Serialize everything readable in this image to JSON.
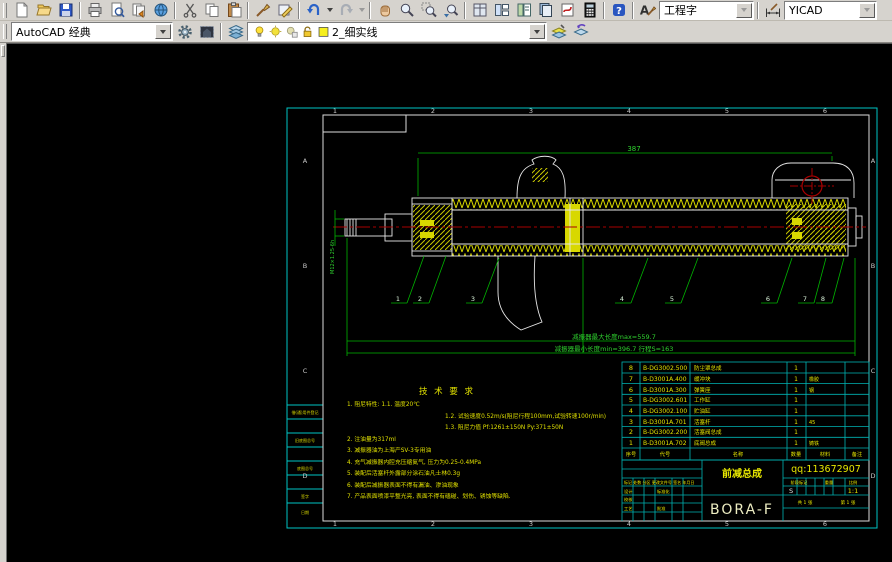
{
  "app": {
    "canvas_bg": "#000000",
    "toolbar_bg": "#d6d3ce",
    "frame_color": "#00c4c4",
    "dim_color": "#2fd32f",
    "hatch_color": "#d8d800"
  },
  "toolbar": {
    "workspace_combo": "AutoCAD 经典",
    "text_style_combo": "工程字",
    "dim_style_combo": "YICAD",
    "layer_combo": "2_细实线",
    "help_glyph": "?",
    "textstyle_glyph": "A"
  },
  "frame": {
    "zones": [
      "1",
      "2",
      "3",
      "4",
      "5",
      "6"
    ],
    "rows": [
      "A",
      "B",
      "C",
      "D"
    ],
    "margin_labels": [
      "借(通)用件登记",
      "旧底图总号",
      "底图总号",
      "签字",
      "日期"
    ]
  },
  "dims": {
    "overall": "387",
    "thread": "M12×1.25-6h",
    "max_len": "减振器最大长度max=559.7",
    "min_len": "减振器最小长度min=396.7  行程S=163"
  },
  "balloons": [
    "1",
    "2",
    "3",
    "4",
    "5",
    "6",
    "7",
    "8"
  ],
  "tech": {
    "title": "技 术 要 求",
    "lines": [
      "1. 阻尼特性: 1.1. 温度20℃",
      "1.2. 试验速度0.52m/s(阻尼行程100mm,试验转速100r/min)",
      "1.3. 阻尼力值  Pf:1261±150N   Py:371±50N",
      "2. 注油量为317ml",
      "3. 减振器油为上海产SV-3专用油",
      "4. 充气减振器内腔充压缩氮气, 压力为0.25-0.4MPa",
      "5. 装配后活塞杆外露部分涂石油凡士林0.3g",
      "6. 装配后减振器表面不得有漏油、渗油现象",
      "7. 产品表面喷漆平整光亮, 表面不得有磕碰、划伤、锈蚀等缺陷."
    ]
  },
  "bom": {
    "headers": [
      "序号",
      "代号",
      "名称",
      "数量",
      "材料",
      "备注"
    ],
    "rows": [
      {
        "no": "8",
        "code": "B-DG3002.500",
        "name": "防尘罩总成",
        "qty": "1",
        "mat": ""
      },
      {
        "no": "7",
        "code": "B-D3001A.400",
        "name": "缓冲块",
        "qty": "1",
        "mat": "橡胶"
      },
      {
        "no": "6",
        "code": "B-D3001A.300",
        "name": "弹簧座",
        "qty": "1",
        "mat": "钢"
      },
      {
        "no": "5",
        "code": "B-DG3002.601",
        "name": "工作缸",
        "qty": "1",
        "mat": ""
      },
      {
        "no": "4",
        "code": "B-DG3002.100",
        "name": "贮油缸",
        "qty": "1",
        "mat": ""
      },
      {
        "no": "3",
        "code": "B-D3001A.701",
        "name": "活塞杆",
        "qty": "1",
        "mat": "45"
      },
      {
        "no": "2",
        "code": "B-DG3002.200",
        "name": "活塞阀总成",
        "qty": "1",
        "mat": ""
      },
      {
        "no": "1",
        "code": "B-D3001A.702",
        "name": "底阀总成",
        "qty": "1",
        "mat": "铸铁"
      }
    ]
  },
  "titleblock": {
    "part_name": "前减总成",
    "model": "BORA-F",
    "qq": "qq:113672907",
    "rev_header": "标记 处数 分区 更改文件号 签名 年月日",
    "sign_design": "设计",
    "sign_check": "校核",
    "sign_standard": "标准化",
    "sign_craft": "工艺",
    "sign_approve": "批准",
    "stage": "阶段标记",
    "weight": "重量",
    "scale_label": "比例",
    "s": "S",
    "scale": "1:1",
    "sheet_total": "共 1 张",
    "sheet_no": "第 1 张"
  }
}
